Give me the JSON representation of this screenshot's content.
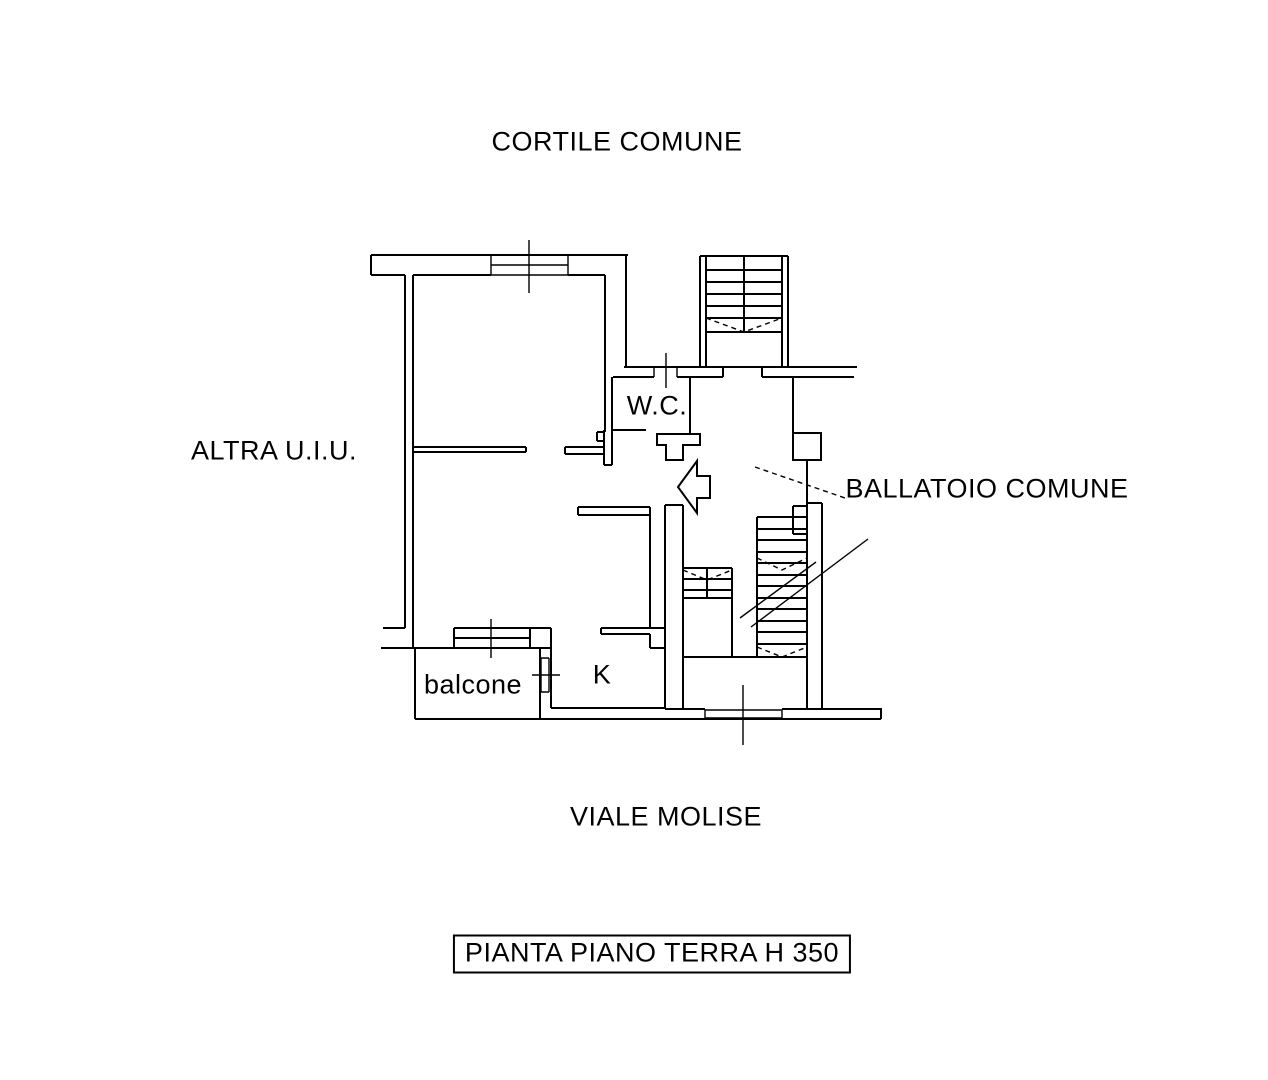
{
  "page": {
    "background_color": "#ffffff",
    "line_color": "#000000"
  },
  "labels": {
    "cortile": "CORTILE COMUNE",
    "altra_uiu": "ALTRA U.I.U.",
    "wc": "W.C.",
    "ballatoio": "BALLATOIO COMUNE",
    "balcone": "balcone",
    "kitchen": "K",
    "viale": "VIALE MOLISE"
  },
  "caption": {
    "text": "PIANTA PIANO TERRA H 350"
  }
}
